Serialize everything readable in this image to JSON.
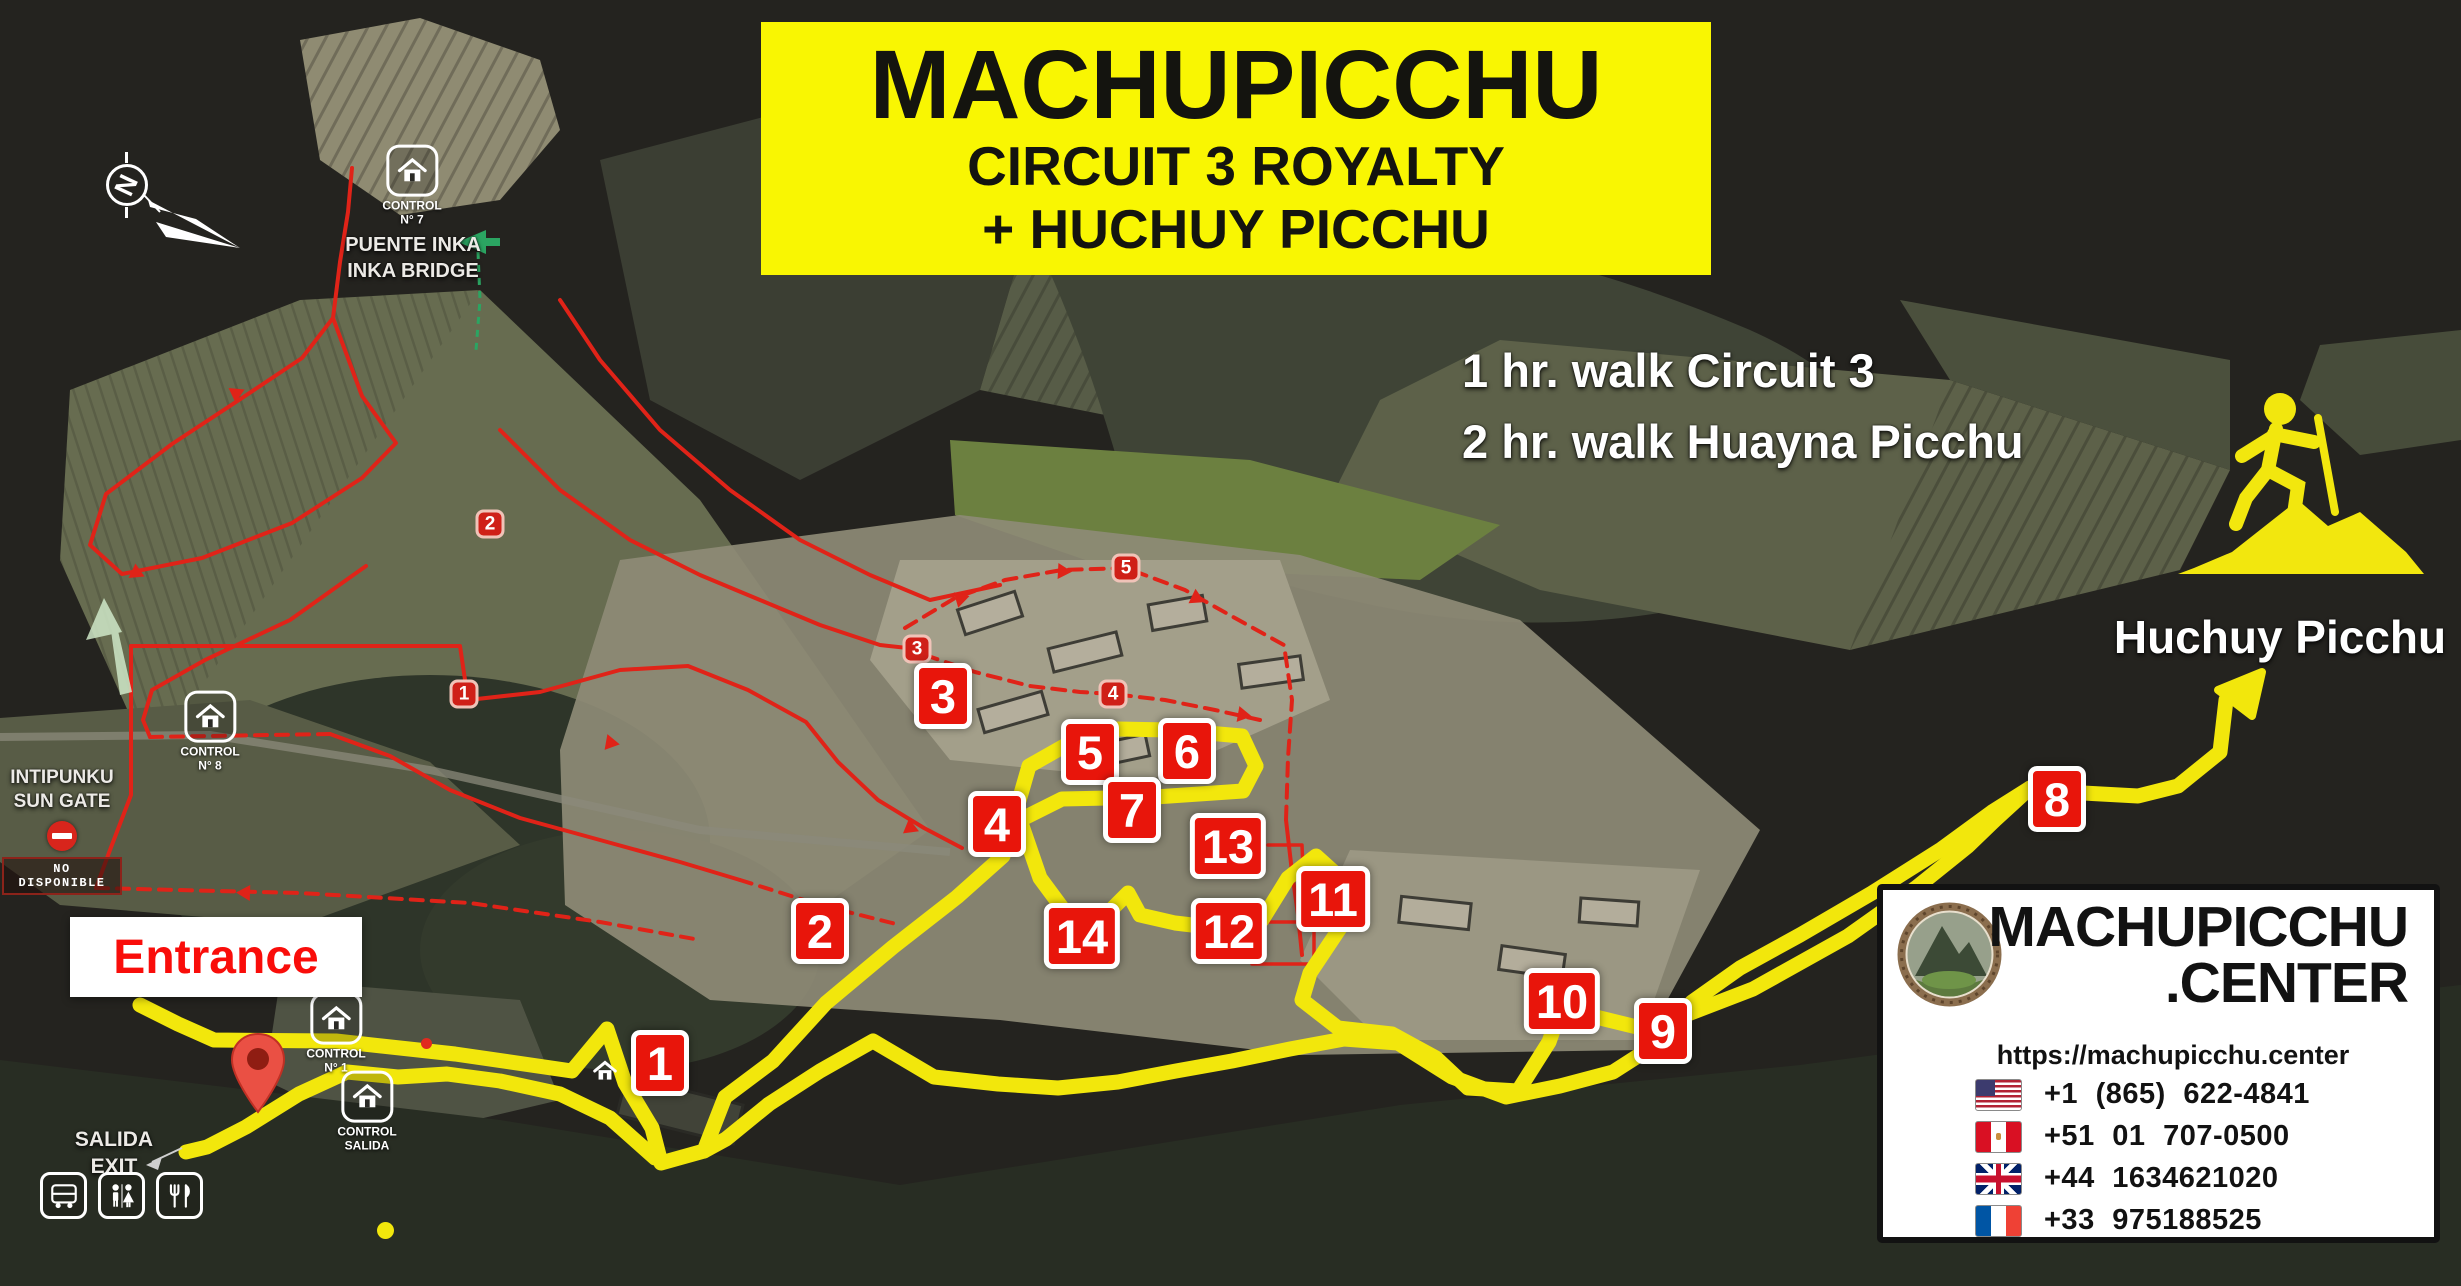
{
  "title": {
    "line1": "MACHUPICCHU",
    "line2": "CIRCUIT 3 ROYALTY",
    "line3": "+ HUCHUY PICCHU"
  },
  "walk_info": {
    "line1": "1 hr. walk Circuit 3",
    "line2": "2 hr. walk Huayna Picchu"
  },
  "huchuy": {
    "label": "Huchuy Picchu",
    "icon": "hiker-mountain-icon"
  },
  "compass": {
    "label": "N"
  },
  "entrance": {
    "label": "Entrance"
  },
  "exit_sign": {
    "line1": "SALIDA",
    "line2": "EXIT"
  },
  "sun_gate": {
    "line1": "INTIPUNKU",
    "line2": "SUN GATE",
    "closed_label": "NO DISPONIBLE"
  },
  "inka_bridge": {
    "line1": "PUENTE INKA",
    "line2": "INKA BRIDGE"
  },
  "controls": [
    {
      "line1": "CONTROL",
      "line2": "N° 7"
    },
    {
      "line1": "CONTROL",
      "line2": "N° 8"
    },
    {
      "line1": "CONTROL",
      "line2": "N° 1"
    },
    {
      "line1": "CONTROL",
      "line2": "SALIDA"
    }
  ],
  "route_markers": [
    "1",
    "2",
    "3",
    "4",
    "5",
    "6",
    "7",
    "8",
    "9",
    "10",
    "11",
    "12",
    "13",
    "14"
  ],
  "circuit_markers": [
    "1",
    "2",
    "3",
    "4",
    "5"
  ],
  "contact": {
    "brand_line1": "MACHUPICCHU",
    "brand_line2": ".CENTER",
    "url": "https://machupicchu.center",
    "phones": [
      {
        "flag": "us-flag-icon",
        "number": "+1 (865) 622-4841"
      },
      {
        "flag": "peru-flag-icon",
        "number": "+51 01 707-0500"
      },
      {
        "flag": "uk-flag-icon",
        "number": "+44 1634621020"
      },
      {
        "flag": "france-flag-icon",
        "number": "+33 975188525"
      }
    ]
  },
  "colors": {
    "accent_yellow": "#f9f602",
    "route_yellow": "#f2e70c",
    "marker_red": "#e8150b",
    "entrance_red": "#f90d0a",
    "map_background": "#24231f"
  }
}
